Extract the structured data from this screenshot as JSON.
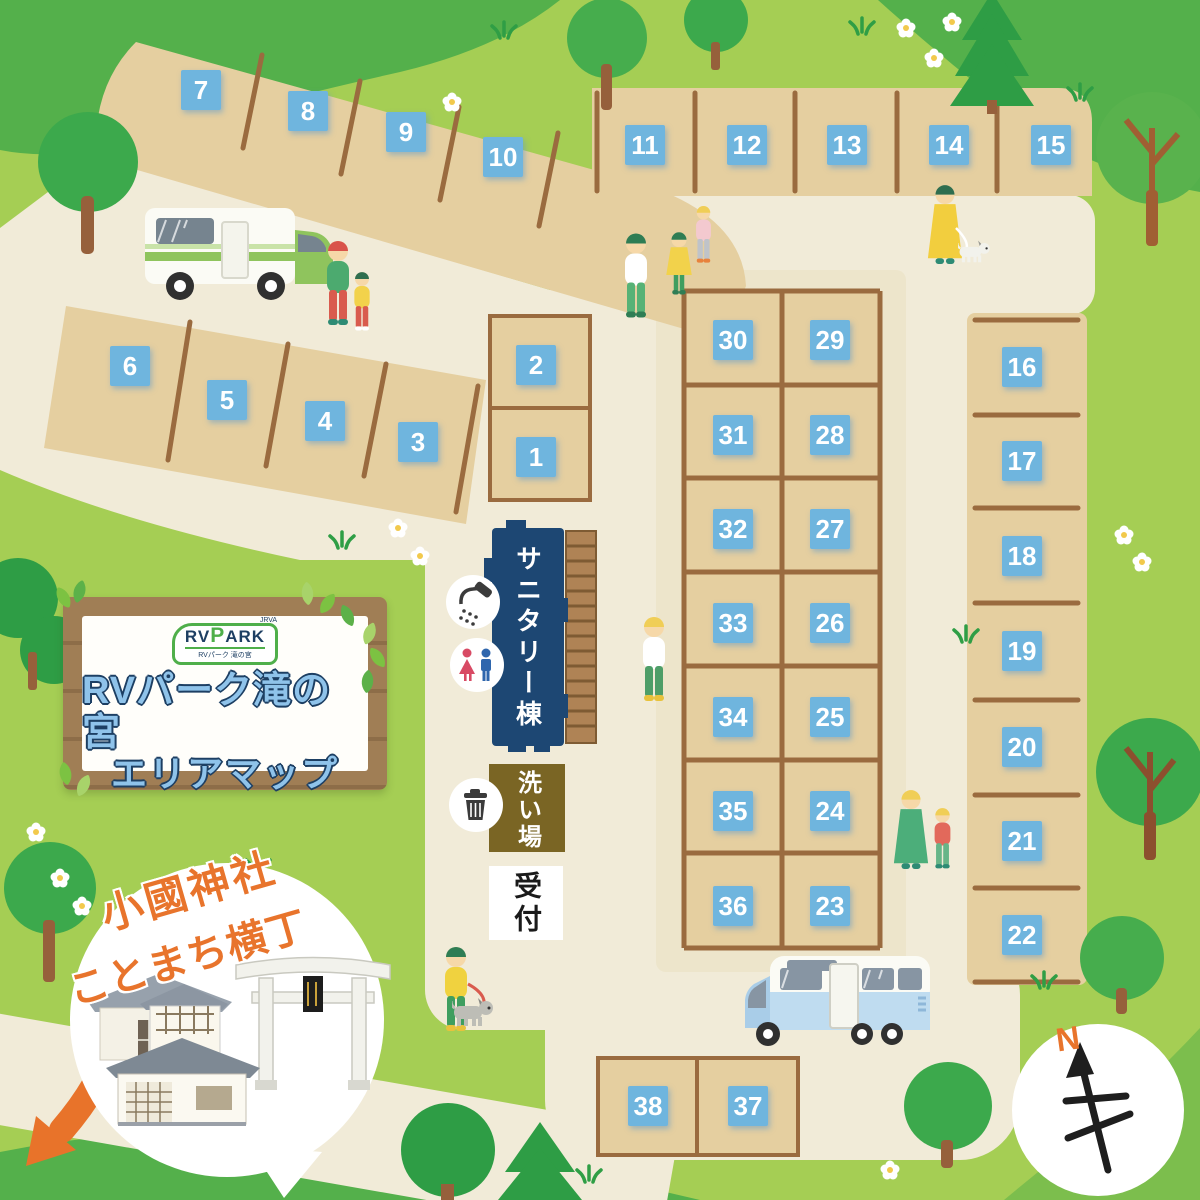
{
  "sign": {
    "logo": {
      "jrva": "JRVA",
      "rv": "RV",
      "p": "P",
      "ark": "ARK",
      "subtitle": "RVパーク 滝の宮"
    },
    "title_line1": "RVパーク滝の宮",
    "title_line2": "エリアマップ"
  },
  "bubble": {
    "line1": "小國神社",
    "line2": "ことまち横丁"
  },
  "facilities": {
    "sanitary": "サニタリー棟",
    "washing": "洗い場",
    "reception": "受付"
  },
  "compass_north": "N",
  "lots": [
    "1",
    "2",
    "3",
    "4",
    "5",
    "6",
    "7",
    "8",
    "9",
    "10",
    "11",
    "12",
    "13",
    "14",
    "15",
    "16",
    "17",
    "18",
    "19",
    "20",
    "21",
    "22",
    "23",
    "24",
    "25",
    "26",
    "27",
    "28",
    "29",
    "30",
    "31",
    "32",
    "33",
    "34",
    "35",
    "36",
    "37",
    "38"
  ],
  "icons": {
    "shower": "shower-icon",
    "restroom": "restroom-icon",
    "trash": "trash-icon",
    "north_arrow": "north-arrow-icon"
  },
  "colors": {
    "grass_green": "#A5CE54",
    "hill_green": "#54B04B",
    "path_cream": "#F1EBD8",
    "lot_tan": "#E5CFA0",
    "wood_brown": "#9A6B3F",
    "lot_tag_blue": "#6FB5DE",
    "sanitary_navy": "#1D4773",
    "washing_olive": "#7A6524",
    "accent_orange": "#E8742C"
  }
}
